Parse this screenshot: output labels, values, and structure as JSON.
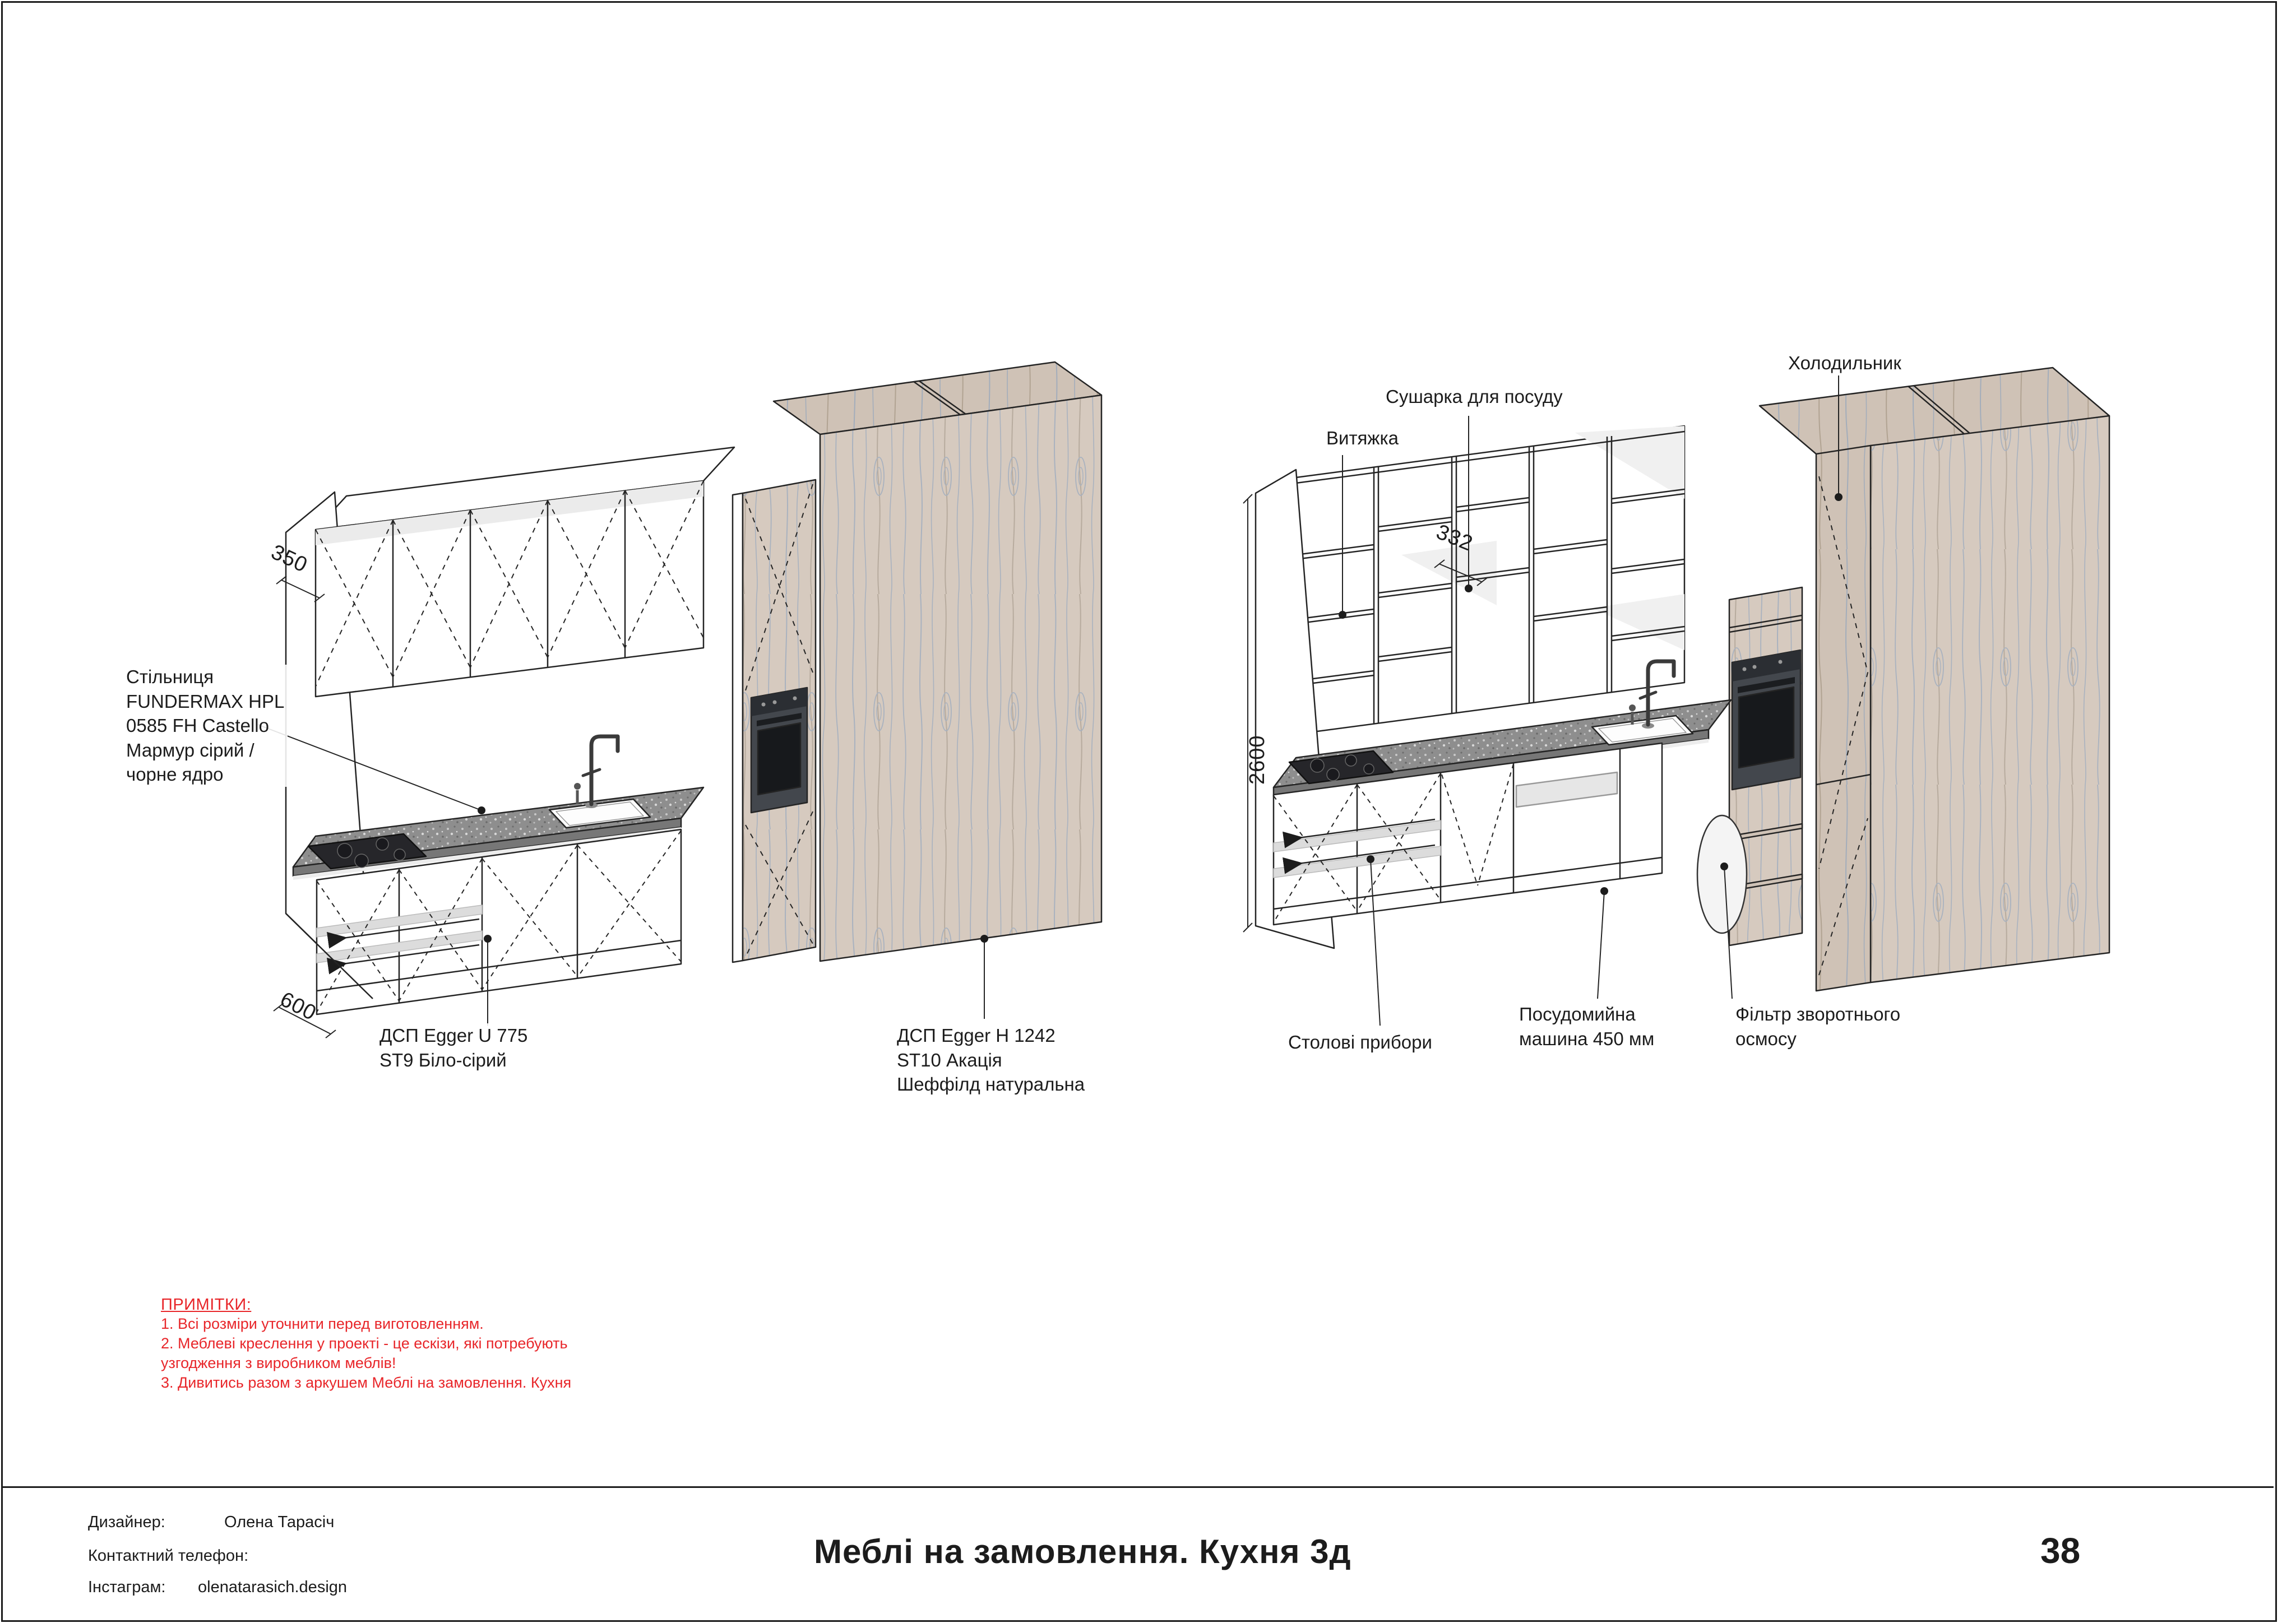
{
  "page": {
    "title": "Меблі на замовлення. Кухня 3д",
    "number": "38"
  },
  "footer": {
    "designer_label": "Дизайнер:",
    "designer_value": "Олена Тарасіч",
    "phone_label": "Контактний телефон:",
    "phone_value": "",
    "instagram_label": "Інстаграм:",
    "instagram_value": "olenatarasich.design"
  },
  "notes": {
    "title": "ПРИМІТКИ:",
    "items": [
      "1. Всі розміри уточнити перед виготовленням.",
      "2. Меблеві креслення у проекті - це ескізи, які потребують\nузгодження з виробником меблів!",
      "3. Дивитись разом з аркушем Меблі на замовлення. Кухня"
    ]
  },
  "left_view": {
    "annotations": {
      "worktop": "Стільниця\nFUNDERMAX HPL\n0585 FH Castello\nМармур сірий /\nчорне ядро",
      "board_white": "ДСП Egger U 775\nST9 Біло-сірий",
      "board_wood": "ДСП Egger H 1242\nST10 Акація\nШеффілд натуральна"
    },
    "dimensions": {
      "top_depth": "350",
      "base_depth": "600"
    }
  },
  "right_view": {
    "annotations": {
      "hood": "Витяжка",
      "dish_dryer": "Сушарка для посуду",
      "fridge": "Холодильник",
      "cutlery": "Столові прибори",
      "dishwasher": "Посудомийна\nмашина 450 мм",
      "osmosis_filter": "Фільтр зворотнього\nосмосу"
    },
    "dimensions": {
      "height": "2600",
      "shelf_depth": "332"
    }
  },
  "palette": {
    "note_red": "#e8262a",
    "wood": "#d6cabf",
    "wood_grain": "#a9b2bf",
    "countertop": "#8e8e8e",
    "appliance_dark": "#43474d"
  }
}
